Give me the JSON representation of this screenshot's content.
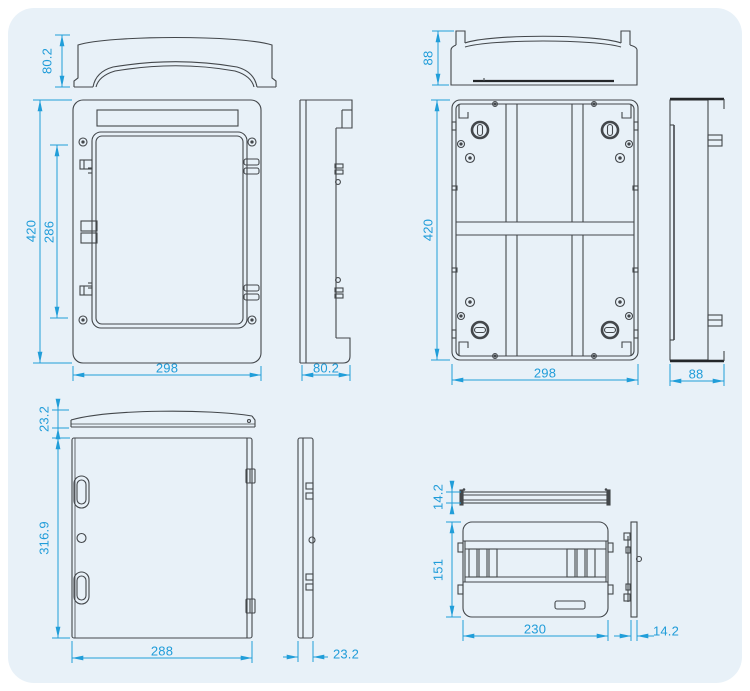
{
  "palette": {
    "page_background": "#ffffff",
    "panel_background": "#e8f1f8",
    "outline": "#43474b",
    "dimension": "#219ed9"
  },
  "views": {
    "front_cover_profile": {
      "dims": {
        "height": "80.2"
      }
    },
    "front_view": {
      "dims": {
        "height": "420",
        "window_height": "286",
        "width": "298"
      }
    },
    "front_side_view": {
      "dims": {
        "depth": "80.2"
      }
    },
    "base_top_view": {
      "dims": {
        "height": "88"
      }
    },
    "base_back_view": {
      "dims": {
        "height": "420",
        "width": "298"
      }
    },
    "base_side_view": {
      "dims": {
        "depth": "88"
      }
    },
    "door_top_profile": {
      "dims": {
        "height": "23.2"
      }
    },
    "door_front_view": {
      "dims": {
        "height": "316.9",
        "width": "288"
      }
    },
    "door_side_view": {
      "dims": {
        "depth": "23.2"
      }
    },
    "rail_profile": {
      "dims": {
        "height": "14.2"
      }
    },
    "module_plate_view": {
      "dims": {
        "height": "151",
        "width": "230"
      }
    },
    "module_plate_side_view": {
      "dims": {
        "depth": "14.2"
      }
    }
  }
}
